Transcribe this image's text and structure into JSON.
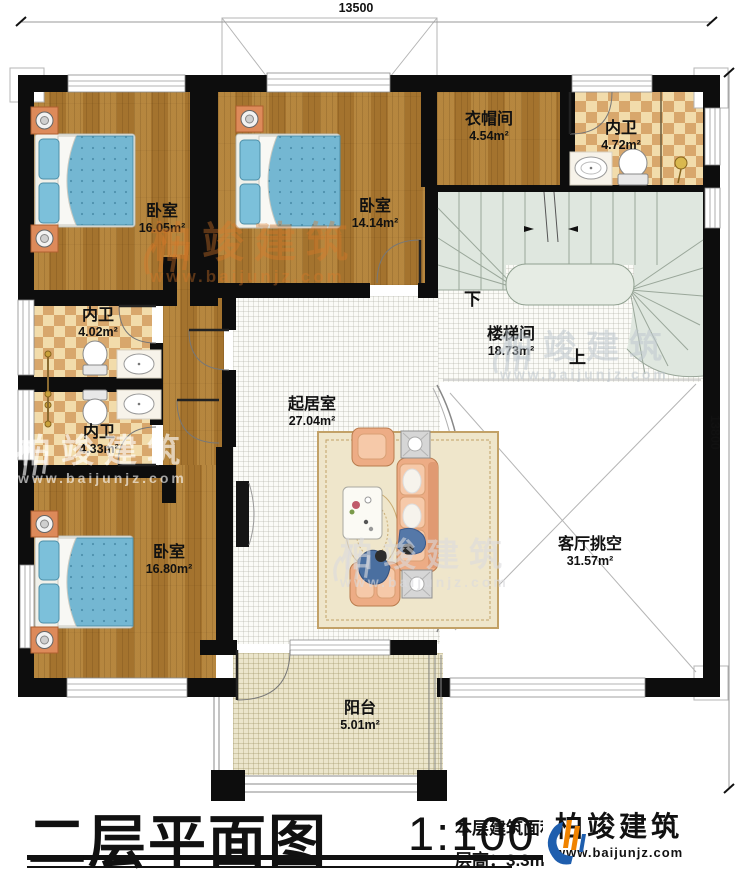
{
  "plan": {
    "dimensions": {
      "top": "13500",
      "right": "13800"
    },
    "rooms": [
      {
        "id": "bedroom-1",
        "name": "卧室",
        "area": "16.05m²"
      },
      {
        "id": "bedroom-2",
        "name": "卧室",
        "area": "14.14m²"
      },
      {
        "id": "cloakroom",
        "name": "衣帽间",
        "area": "4.54m²"
      },
      {
        "id": "bath-top",
        "name": "内卫",
        "area": "4.72m²"
      },
      {
        "id": "bath-mid",
        "name": "内卫",
        "area": "4.02m²"
      },
      {
        "id": "bath-low",
        "name": "内卫",
        "area": "4.33m²"
      },
      {
        "id": "bedroom-3",
        "name": "卧室",
        "area": "16.80m²"
      },
      {
        "id": "living",
        "name": "起居室",
        "area": "27.04m²"
      },
      {
        "id": "stairwell",
        "name": "楼梯间",
        "area": "18.73m²"
      },
      {
        "id": "void",
        "name": "客厅挑空",
        "area": "31.57m²"
      },
      {
        "id": "balcony",
        "name": "阳台",
        "area": "5.01m²"
      }
    ],
    "stair_labels": {
      "down": "下",
      "up": "上"
    }
  },
  "title_block": {
    "title": "二层平面图",
    "scale": "1:100",
    "area_label": "本层建筑面积：",
    "floor_height": "层高：3.3m"
  },
  "branding": {
    "logo_name": "柏竣建筑",
    "logo_url": "www.baijunjz.com",
    "watermark_name": "柏竣建筑",
    "watermark_url": "www.baijunjz.com",
    "colors": {
      "logo_blue": "#1e5eae",
      "logo_orange": "#f08300",
      "wood": "#ae7c33",
      "tile_tan": "#d8a76c",
      "stair_green": "#dfe7df"
    }
  }
}
